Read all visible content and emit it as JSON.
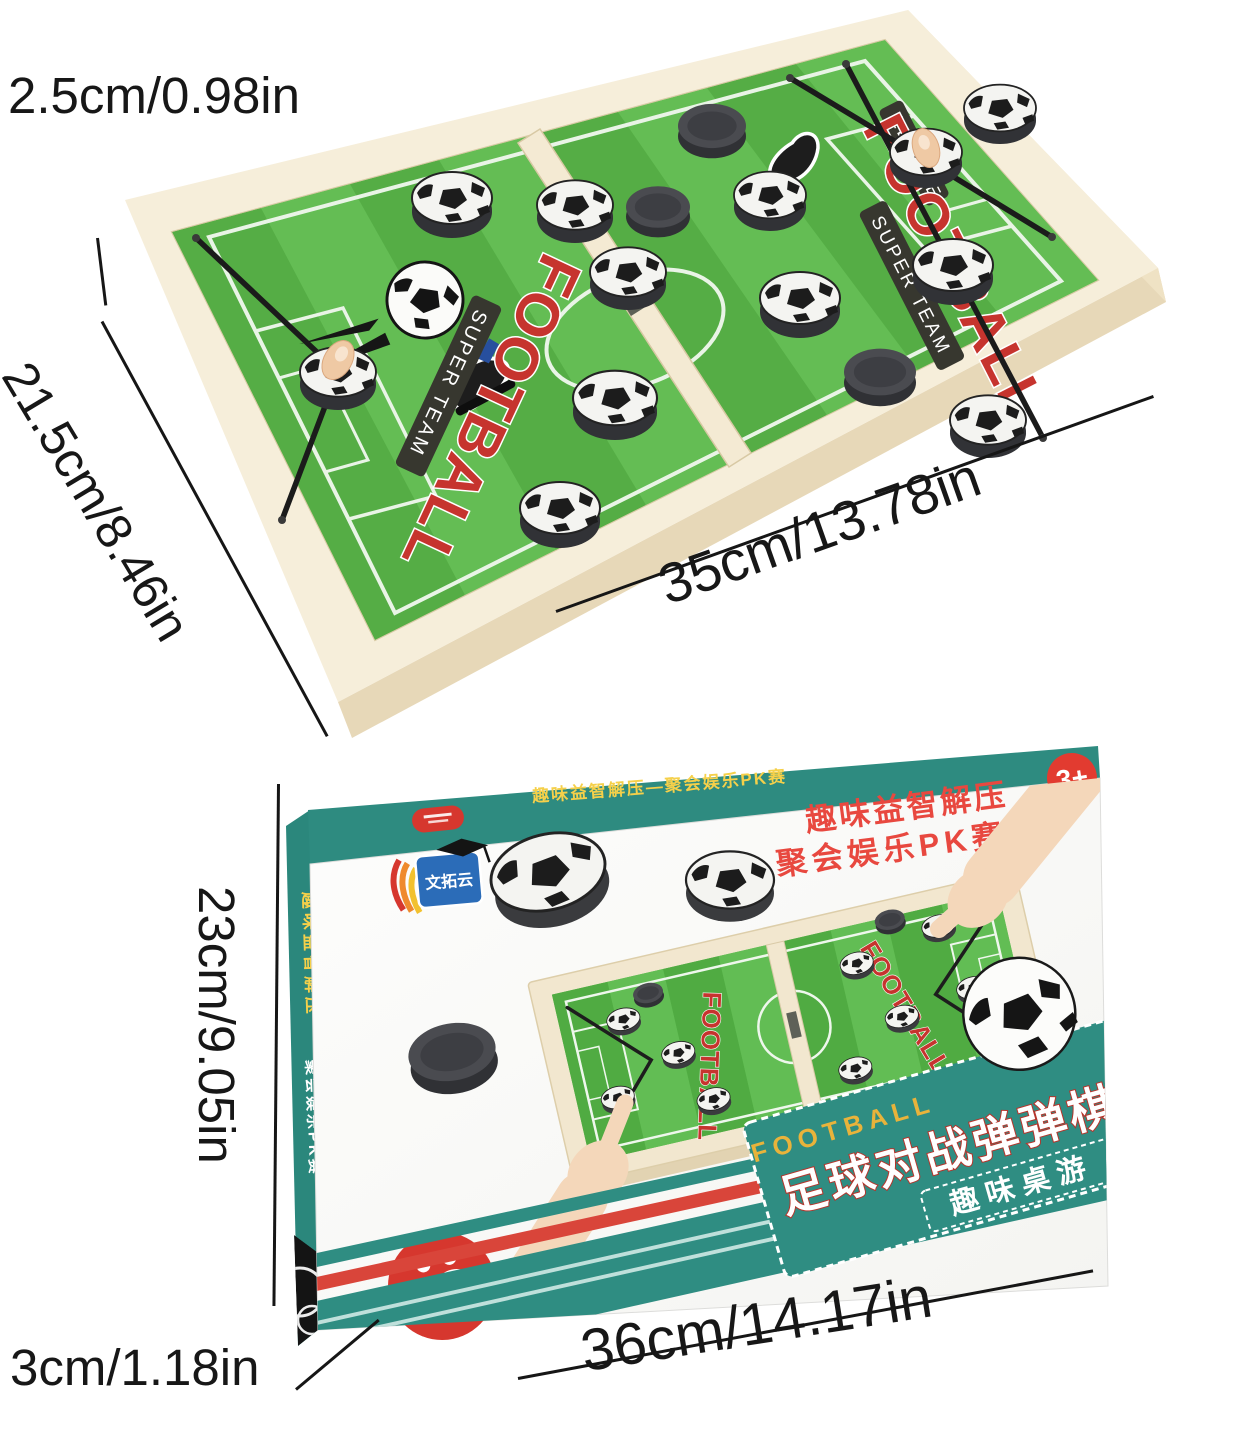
{
  "product": {
    "board": {
      "thickness_label": "2.5cm/0.98in",
      "width_label": "21.5cm/8.46in",
      "length_label": "35cm/13.78in",
      "logo": {
        "league": "LEAGUE",
        "title": "FOOTBALL",
        "subtitle": "SUPER TEAM"
      }
    },
    "box": {
      "height_label": "23cm/9.05in",
      "depth_label": "3cm/1.18in",
      "length_label": "36cm/14.17in",
      "age_badge": "3+",
      "top_strip_text": "趣味益智解压—聚会娱乐PK赛",
      "side_text_primary": "趣味益智解压",
      "side_text_secondary": "聚会娱乐PK赛",
      "slogan_line1": "趣味益智解压",
      "slogan_line2": "聚会娱乐PK赛",
      "brand_logo_text": "文拓云",
      "ribbon_en": "FOOTBALL",
      "ribbon_title": "足球对战弹弹棋",
      "ribbon_subtitle": "趣味桌游",
      "players_badge_text": "双人玩家"
    },
    "colors": {
      "teal": "#2E8B80",
      "red": "#D6372E",
      "field_green": "#57B44A",
      "wood": "#F2E7CF"
    }
  }
}
